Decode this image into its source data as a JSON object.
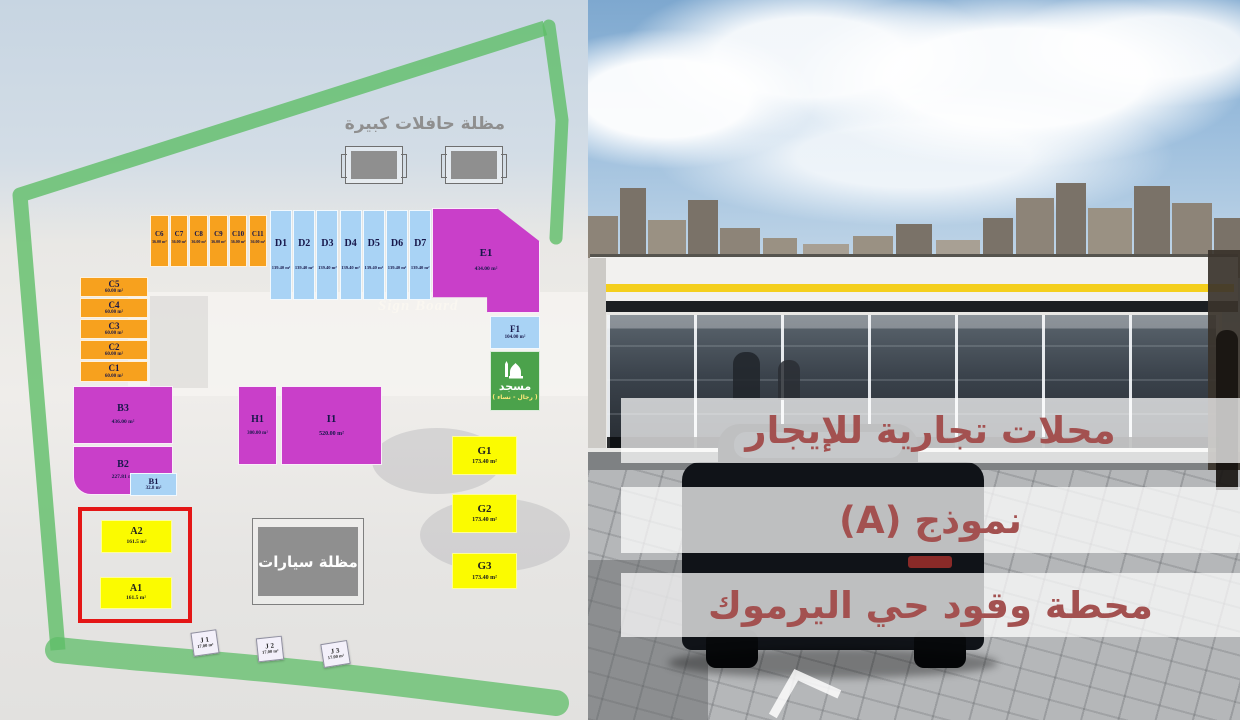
{
  "right_panel": {
    "overlay_lines": [
      "محلات تجارية للإيجار",
      "نموذج (A)",
      "محطة وقود حي اليرموك"
    ],
    "overlay_text_color": "#a35150"
  },
  "site_plan": {
    "bus_shelter_label": "مظلة حافلات كبيرة",
    "car_shelter_label": "مظلة سيارات",
    "sign_board_label": "Sign Board",
    "mosque": {
      "label": "مسجد",
      "sublabel": "( رجال - نساء )"
    },
    "colors": {
      "orange": "#F7A11E",
      "blue": "#A9D3F5",
      "magenta": "#C93FC9",
      "yellow": "#FBFB00",
      "mosque_green": "#4BA24B",
      "border_green": "#5FBE68",
      "highlight_red": "#E41616",
      "shelter_gray": "#8F8F8F"
    },
    "units": [
      {
        "id": "C5",
        "area": "60.00 m²",
        "cls": "orange",
        "x": 80,
        "y": 277,
        "w": 68,
        "h": 20,
        "idSize": 9,
        "areaSize": 5,
        "gap": 0
      },
      {
        "id": "C4",
        "area": "60.00 m²",
        "cls": "orange",
        "x": 80,
        "y": 298,
        "w": 68,
        "h": 20,
        "idSize": 9,
        "areaSize": 5,
        "gap": 0
      },
      {
        "id": "C3",
        "area": "60.00 m²",
        "cls": "orange",
        "x": 80,
        "y": 319,
        "w": 68,
        "h": 20,
        "idSize": 9,
        "areaSize": 5,
        "gap": 0
      },
      {
        "id": "C2",
        "area": "60.00 m²",
        "cls": "orange",
        "x": 80,
        "y": 340,
        "w": 68,
        "h": 20,
        "idSize": 9,
        "areaSize": 5,
        "gap": 0
      },
      {
        "id": "C1",
        "area": "60.00 m²",
        "cls": "orange",
        "x": 80,
        "y": 361,
        "w": 68,
        "h": 21,
        "idSize": 9,
        "areaSize": 5,
        "gap": 0
      },
      {
        "id": "C6",
        "area": "36.00 m²",
        "cls": "orange",
        "x": 150,
        "y": 215,
        "w": 18.5,
        "h": 52,
        "idSize": 7,
        "areaSize": 4,
        "pt": 15,
        "gap": 2
      },
      {
        "id": "C7",
        "area": "36.00 m²",
        "cls": "orange",
        "x": 169.7,
        "y": 215,
        "w": 18.5,
        "h": 52,
        "idSize": 7,
        "areaSize": 4,
        "pt": 15,
        "gap": 2
      },
      {
        "id": "C8",
        "area": "36.00 m²",
        "cls": "orange",
        "x": 189.4,
        "y": 215,
        "w": 18.5,
        "h": 52,
        "idSize": 7,
        "areaSize": 4,
        "pt": 15,
        "gap": 2
      },
      {
        "id": "C9",
        "area": "36.00 m²",
        "cls": "orange",
        "x": 209.1,
        "y": 215,
        "w": 18.5,
        "h": 52,
        "idSize": 7,
        "areaSize": 4,
        "pt": 15,
        "gap": 2
      },
      {
        "id": "C10",
        "area": "36.00 m²",
        "cls": "orange",
        "x": 228.8,
        "y": 215,
        "w": 18.5,
        "h": 52,
        "idSize": 7,
        "areaSize": 4,
        "pt": 15,
        "gap": 2
      },
      {
        "id": "C11",
        "area": "36.00 m²",
        "cls": "orange",
        "x": 248.5,
        "y": 215,
        "w": 18.5,
        "h": 52,
        "idSize": 7,
        "areaSize": 4,
        "pt": 15,
        "gap": 2
      },
      {
        "id": "D1",
        "area": "139.40 m²",
        "cls": "blue",
        "x": 270,
        "y": 210,
        "w": 22,
        "h": 90,
        "idSize": 10,
        "areaSize": 4.5,
        "pt": 28,
        "gap": 16
      },
      {
        "id": "D2",
        "area": "139.40 m²",
        "cls": "blue",
        "x": 293.2,
        "y": 210,
        "w": 22,
        "h": 90,
        "idSize": 10,
        "areaSize": 4.5,
        "pt": 28,
        "gap": 16
      },
      {
        "id": "D3",
        "area": "139.40 m²",
        "cls": "blue",
        "x": 316.4,
        "y": 210,
        "w": 22,
        "h": 90,
        "idSize": 10,
        "areaSize": 4.5,
        "pt": 28,
        "gap": 16
      },
      {
        "id": "D4",
        "area": "139.40 m²",
        "cls": "blue",
        "x": 339.6,
        "y": 210,
        "w": 22,
        "h": 90,
        "idSize": 10,
        "areaSize": 4.5,
        "pt": 28,
        "gap": 16
      },
      {
        "id": "D5",
        "area": "139.40 m²",
        "cls": "blue",
        "x": 362.8,
        "y": 210,
        "w": 22,
        "h": 90,
        "idSize": 10,
        "areaSize": 4.5,
        "pt": 28,
        "gap": 16
      },
      {
        "id": "D6",
        "area": "139.40 m²",
        "cls": "blue",
        "x": 386,
        "y": 210,
        "w": 22,
        "h": 90,
        "idSize": 10,
        "areaSize": 4.5,
        "pt": 28,
        "gap": 16
      },
      {
        "id": "D7",
        "area": "139.40 m²",
        "cls": "blue",
        "x": 409.2,
        "y": 210,
        "w": 22,
        "h": 90,
        "idSize": 10,
        "areaSize": 4.5,
        "pt": 28,
        "gap": 16
      },
      {
        "id": "E1",
        "area": "434.00 m²",
        "cls": "magenta",
        "x": 432,
        "y": 208,
        "w": 108,
        "h": 105,
        "idSize": 11,
        "areaSize": 5.5,
        "gap": 8,
        "clip": "polygon(0% 0%, 60% 0%, 100% 32%, 100% 100%, 51% 100%, 51% 85%, 0% 85%)"
      },
      {
        "id": "F1",
        "area": "104.00 m²",
        "cls": "blue",
        "x": 490,
        "y": 316,
        "w": 50,
        "h": 33,
        "idSize": 9,
        "areaSize": 5,
        "gap": 1
      },
      {
        "id": "B3",
        "area": "436.00 m²",
        "cls": "magenta",
        "x": 73,
        "y": 386,
        "w": 100,
        "h": 58,
        "idSize": 10,
        "areaSize": 5.5,
        "gap": 5
      },
      {
        "id": "B2",
        "area": "227.81 m²",
        "cls": "magenta",
        "x": 73,
        "y": 446,
        "w": 100,
        "h": 49,
        "idSize": 10,
        "areaSize": 5.5,
        "gap": 4,
        "radius": "0 0 0 18px"
      },
      {
        "id": "B1",
        "area": "32.8 m²",
        "cls": "blue",
        "x": 130,
        "y": 473,
        "w": 47,
        "h": 23,
        "idSize": 8.5,
        "areaSize": 5,
        "gap": 0
      },
      {
        "id": "H1",
        "area": "300.00 m²",
        "cls": "magenta",
        "x": 238,
        "y": 386,
        "w": 39,
        "h": 79,
        "idSize": 10,
        "areaSize": 5,
        "gap": 6
      },
      {
        "id": "I1",
        "area": "520.00 m²",
        "cls": "magenta",
        "x": 281,
        "y": 386,
        "w": 101,
        "h": 79,
        "idSize": 11,
        "areaSize": 6,
        "gap": 6
      },
      {
        "id": "G1",
        "area": "173.40 m²",
        "cls": "yellow",
        "x": 452,
        "y": 436,
        "w": 65,
        "h": 39,
        "idSize": 11,
        "areaSize": 6,
        "gap": 2
      },
      {
        "id": "G2",
        "area": "173.40 m²",
        "cls": "yellow",
        "x": 452,
        "y": 494,
        "w": 65,
        "h": 39,
        "idSize": 11,
        "areaSize": 6,
        "gap": 2
      },
      {
        "id": "G3",
        "area": "173.40 m²",
        "cls": "yellow",
        "x": 452,
        "y": 553,
        "w": 65,
        "h": 36,
        "idSize": 11,
        "areaSize": 6,
        "gap": 2
      },
      {
        "id": "A2",
        "area": "161.5 m²",
        "cls": "yellow",
        "x": 101,
        "y": 520,
        "w": 71,
        "h": 33,
        "idSize": 10,
        "areaSize": 5.5,
        "gap": 2
      },
      {
        "id": "A1",
        "area": "161.5 m²",
        "cls": "yellow",
        "x": 100,
        "y": 577,
        "w": 72,
        "h": 32,
        "idSize": 10,
        "areaSize": 5.5,
        "gap": 2
      },
      {
        "id": "J1",
        "label": "J 1",
        "area": "17.00 m²",
        "cls": "jwhite",
        "x": 192,
        "y": 631,
        "w": 26,
        "h": 24,
        "idSize": 7,
        "areaSize": 4.5,
        "gap": 0,
        "rotate": -8
      },
      {
        "id": "J2",
        "label": "J 2",
        "area": "17.00 m²",
        "cls": "jwhite",
        "x": 257,
        "y": 637,
        "w": 26,
        "h": 24,
        "idSize": 7,
        "areaSize": 4.5,
        "gap": 0,
        "rotate": -6
      },
      {
        "id": "J3",
        "label": "J 3",
        "area": "17.00 m²",
        "cls": "jwhite",
        "x": 322,
        "y": 642,
        "w": 27,
        "h": 24,
        "idSize": 7,
        "areaSize": 4.5,
        "gap": 0,
        "rotate": -9
      }
    ]
  }
}
